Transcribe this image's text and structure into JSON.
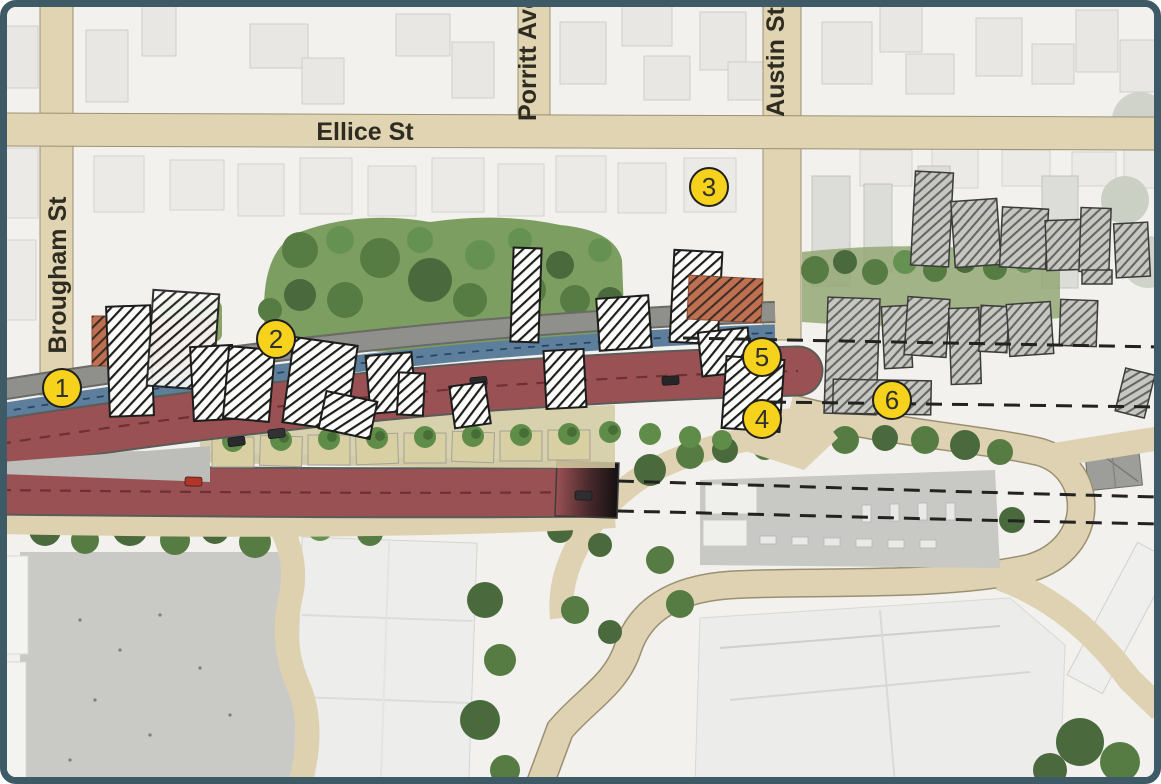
{
  "map": {
    "type": "aerial-roading-scheme-plan",
    "streets": {
      "ellice": "Ellice St",
      "porritt": "Porritt Ave",
      "austin": "Austin St",
      "brougham": "Brougham St"
    },
    "markers": [
      {
        "label": "1"
      },
      {
        "label": "2"
      },
      {
        "label": "3"
      },
      {
        "label": "4"
      },
      {
        "label": "5"
      },
      {
        "label": "6"
      }
    ],
    "legend_colors": {
      "frame_border": "#3e5a66",
      "marker_yellow": "#f6d21c",
      "road_tan": "#e0d4b2",
      "carriageway_red": "#9a5154",
      "shared_path_blue": "#5d7f9c",
      "footpath_grey": "#8f8f8c",
      "vegetation_green": "#7d9e61"
    }
  }
}
